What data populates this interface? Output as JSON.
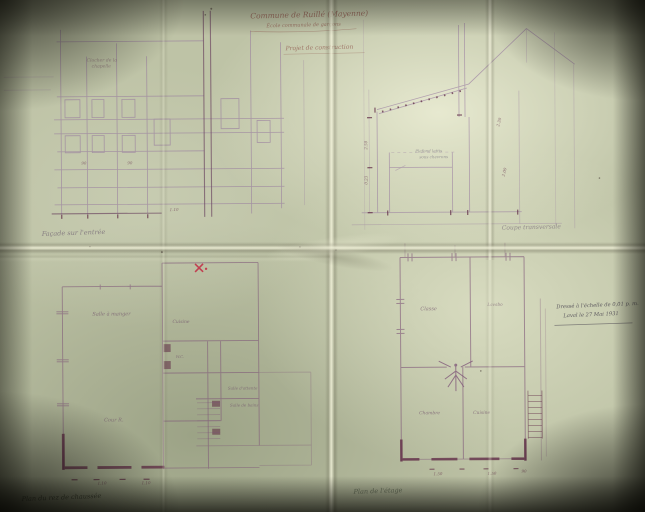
{
  "scene": {
    "description": "Photograph of a folded architectural drawing, faint violet ink on aged paper"
  },
  "colors": {
    "background": "#17160f",
    "paper": "#bec3a6",
    "paper_highlight": "#e9ebd2",
    "ink": "#8e6b9b",
    "wall_ink": "#5f2a44",
    "red_mark": "#c23349",
    "pencil": "#5a6350",
    "title_ink": "#8f564c"
  },
  "title_block": {
    "line1": "Commune de Ruillé (Mayenne)",
    "line2": "École communale de garçons",
    "subtitle": "Projet de construction"
  },
  "elevation": {
    "label": "Façade sur l'entrée",
    "note_line1": "Clocher de la",
    "note_line2": "chapelle",
    "dims": [
      "90",
      "90",
      "1.10"
    ]
  },
  "section": {
    "label": "Coupe transversale",
    "note_line1": "Plafond lattis",
    "note_line2": "sous chevrons",
    "dims_left": [
      "2.50",
      "0.23"
    ],
    "dims_right": [
      "2.30",
      "2.00"
    ]
  },
  "plan_ground": {
    "label": "Plan du rez de chaussée",
    "rooms": {
      "salle_a_manger": "Salle à manger",
      "cuisine": "Cuisine",
      "cour": "Cour R.",
      "wc": "W.C.",
      "attente": "Salle d'attente",
      "bains": "Salle de bains"
    },
    "dims": [
      "1.10",
      "1.10"
    ]
  },
  "plan_floor": {
    "label": "Plan de l'étage",
    "rooms": {
      "classe": "Classe",
      "lavabo": "Lavabo",
      "chambre": "Chambre",
      "cuisine": "Cuisine"
    },
    "dims": [
      "1.50",
      "1.50",
      "90"
    ]
  },
  "annotation": {
    "line1": "Dressé à l'échelle de 0,01 p. m.",
    "line2": "Laval le 27 Mai 1931"
  }
}
